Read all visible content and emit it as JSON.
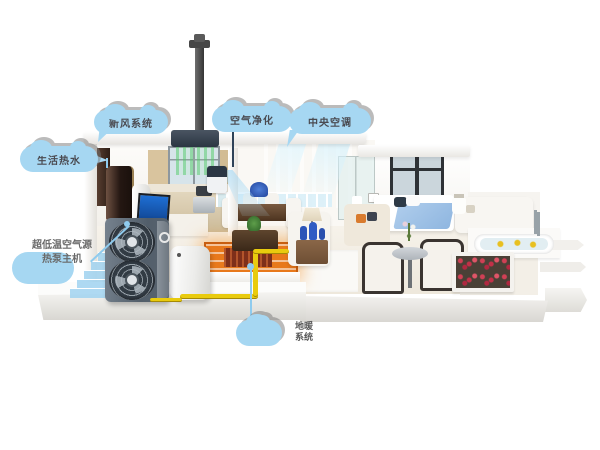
{
  "labels": {
    "fresh_air": "新风系统",
    "purify": "空气净化",
    "central_ac": "中央空调",
    "hot_water": "生活热水",
    "heat_pump_line1": "超低温空气源",
    "heat_pump_line2": "热泵主机",
    "floor_heating_line1": "地暖",
    "floor_heating_line2": "系统"
  },
  "colors": {
    "background": "#FFFFFF",
    "cloud_blue": "#A6D7F2",
    "label_text": "#4A4A50",
    "pipe_yellow": "#E9CB0E",
    "floor_orange": "#E8791C",
    "beam_green": "#5ACD6E",
    "beam_blue": "#9ED4F0",
    "pump_gray": "#5A6570"
  }
}
